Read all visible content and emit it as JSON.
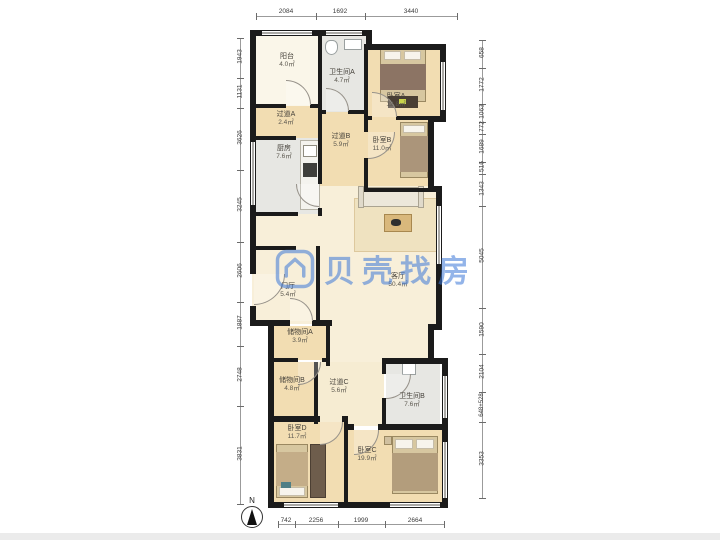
{
  "watermark": {
    "brand": "贝壳找房",
    "logo": "beike-house-logo"
  },
  "compass": {
    "label": "N"
  },
  "rooms": [
    {
      "id": "balcony",
      "name": "阳台",
      "area": "4.0㎡"
    },
    {
      "id": "hallway-a",
      "name": "过道A",
      "area": "2.4㎡"
    },
    {
      "id": "bath-a",
      "name": "卫生间A",
      "area": "4.7㎡"
    },
    {
      "id": "bedroom-a",
      "name": "卧室A",
      "area": "12.8㎡"
    },
    {
      "id": "kitchen",
      "name": "厨房",
      "area": "7.6㎡"
    },
    {
      "id": "hallway-b",
      "name": "过道B",
      "area": "5.9㎡"
    },
    {
      "id": "bedroom-b",
      "name": "卧室B",
      "area": "11.0㎡"
    },
    {
      "id": "living",
      "name": "客厅",
      "area": "50.4㎡"
    },
    {
      "id": "foyer",
      "name": "门厅",
      "area": "5.4㎡"
    },
    {
      "id": "storage-a",
      "name": "储物间A",
      "area": "3.9㎡"
    },
    {
      "id": "storage-b",
      "name": "储物间B",
      "area": "4.8㎡"
    },
    {
      "id": "hallway-c",
      "name": "过道C",
      "area": "5.6㎡"
    },
    {
      "id": "bath-b",
      "name": "卫生间B",
      "area": "7.6㎡"
    },
    {
      "id": "bedroom-d",
      "name": "卧室D",
      "area": "11.7㎡"
    },
    {
      "id": "bedroom-c",
      "name": "卧室C",
      "area": "19.9㎡"
    }
  ],
  "dimensions": {
    "top": [
      "2084",
      "1692",
      "3440"
    ],
    "bottom": [
      "742",
      "2256",
      "1999",
      "2664"
    ],
    "left": [
      "1943",
      "1131",
      "3626",
      "3245",
      "2606",
      "1887",
      "2748",
      "3831"
    ],
    "right": [
      "658",
      "1772",
      "1063",
      "772",
      "1689",
      "516",
      "1343",
      "5045",
      "1590",
      "2104",
      "648+528",
      "3353"
    ]
  },
  "colors": {
    "wall": "#1b1b1b",
    "wood_floor": "#f2ddb2",
    "tile_floor": "#e7e7e3",
    "living_floor": "#f8efd9",
    "balcony_floor": "#faf6e9",
    "watermark_blue": "#3c78d8"
  }
}
